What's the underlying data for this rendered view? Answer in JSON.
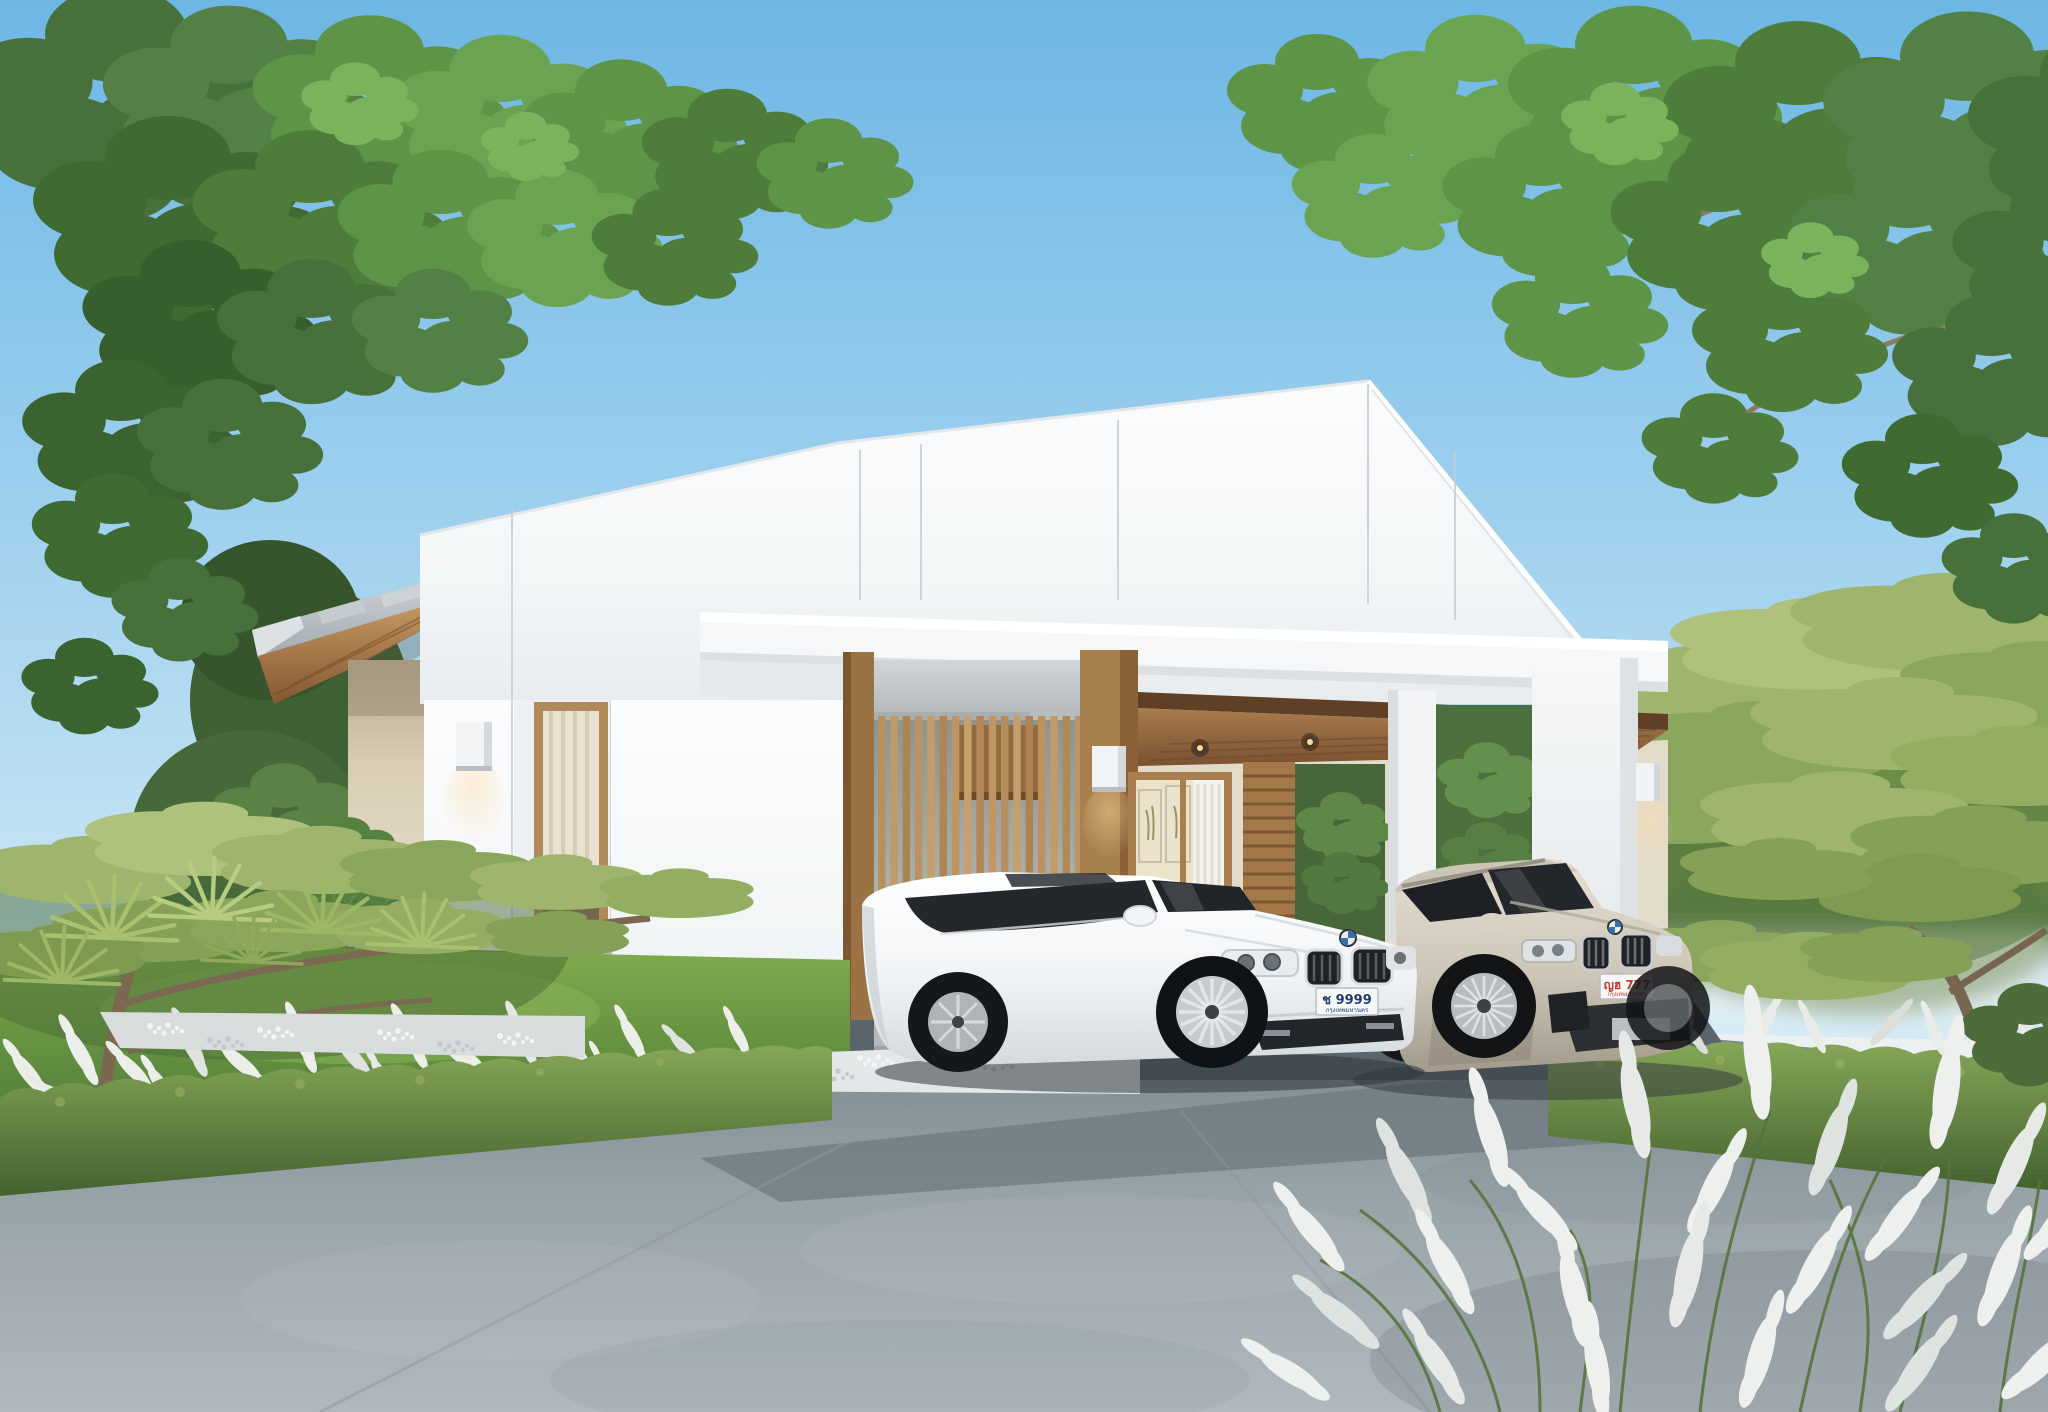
{
  "scene": {
    "type": "3D architectural exterior rendering",
    "subject": "Modern minimalist white single-storey gable house with wood slat accents, double carport with two cars, landscaped garden and concrete driveway",
    "sky": "clear blue day"
  },
  "palette": {
    "sky_top": "#6db7e4",
    "sky_horizon": "#eef6f9",
    "wall_white": "#f7f9fa",
    "wood": "#b8905e",
    "wood_dark": "#7e5731",
    "concrete": "#c3c8cb",
    "roof_metal": "#b8bfc4",
    "driveway": "#9aa5ab",
    "lawn": "#76a247",
    "hedge": "#6f8f4a",
    "foliage": "#5d9448",
    "fence_white": "#edf0f1",
    "lamp_glow": "#ffd9a0"
  },
  "house": {
    "walls": "white panels with vertical seams",
    "roof": "white clipped gable + grey metal shed roof with wood soffit",
    "canopy": "long white flat canopy over slat screen and carport",
    "screen": "vertical wood slat privacy screen on concrete base",
    "deck": "floating wood entry deck with potted fig plant",
    "windows": [
      "tall frosted wood-framed window",
      "carport picture window with two framed artworks and curtain"
    ],
    "wall_lamps": 3,
    "carport_downlights": 4
  },
  "garden": {
    "left": [
      "layered pine tree",
      "fan palms",
      "white feather grass",
      "clipped hedge row",
      "lawn mound",
      "stepping stones",
      "white pebble border"
    ],
    "right": [
      "large layered pine tree",
      "leafy garden trees",
      "white boundary fence",
      "clipped hedge row",
      "white feather grass"
    ],
    "top": [
      "overhanging leafy branches left",
      "overhanging leafy branches right"
    ]
  },
  "cars": {
    "sedan": {
      "type": "white luxury sedan",
      "body_color": "#f2f4f6",
      "plate": "ช 9999",
      "plate_region": "กรุงเทพมหานคร",
      "plate_text_color": "#223b73"
    },
    "suv": {
      "type": "champagne silver SUV",
      "body_color": "#cdc5b7",
      "plate": "ญฮ 777",
      "plate_region": "กรุงเทพมหานคร",
      "plate_text_color": "#c03a2e"
    }
  }
}
